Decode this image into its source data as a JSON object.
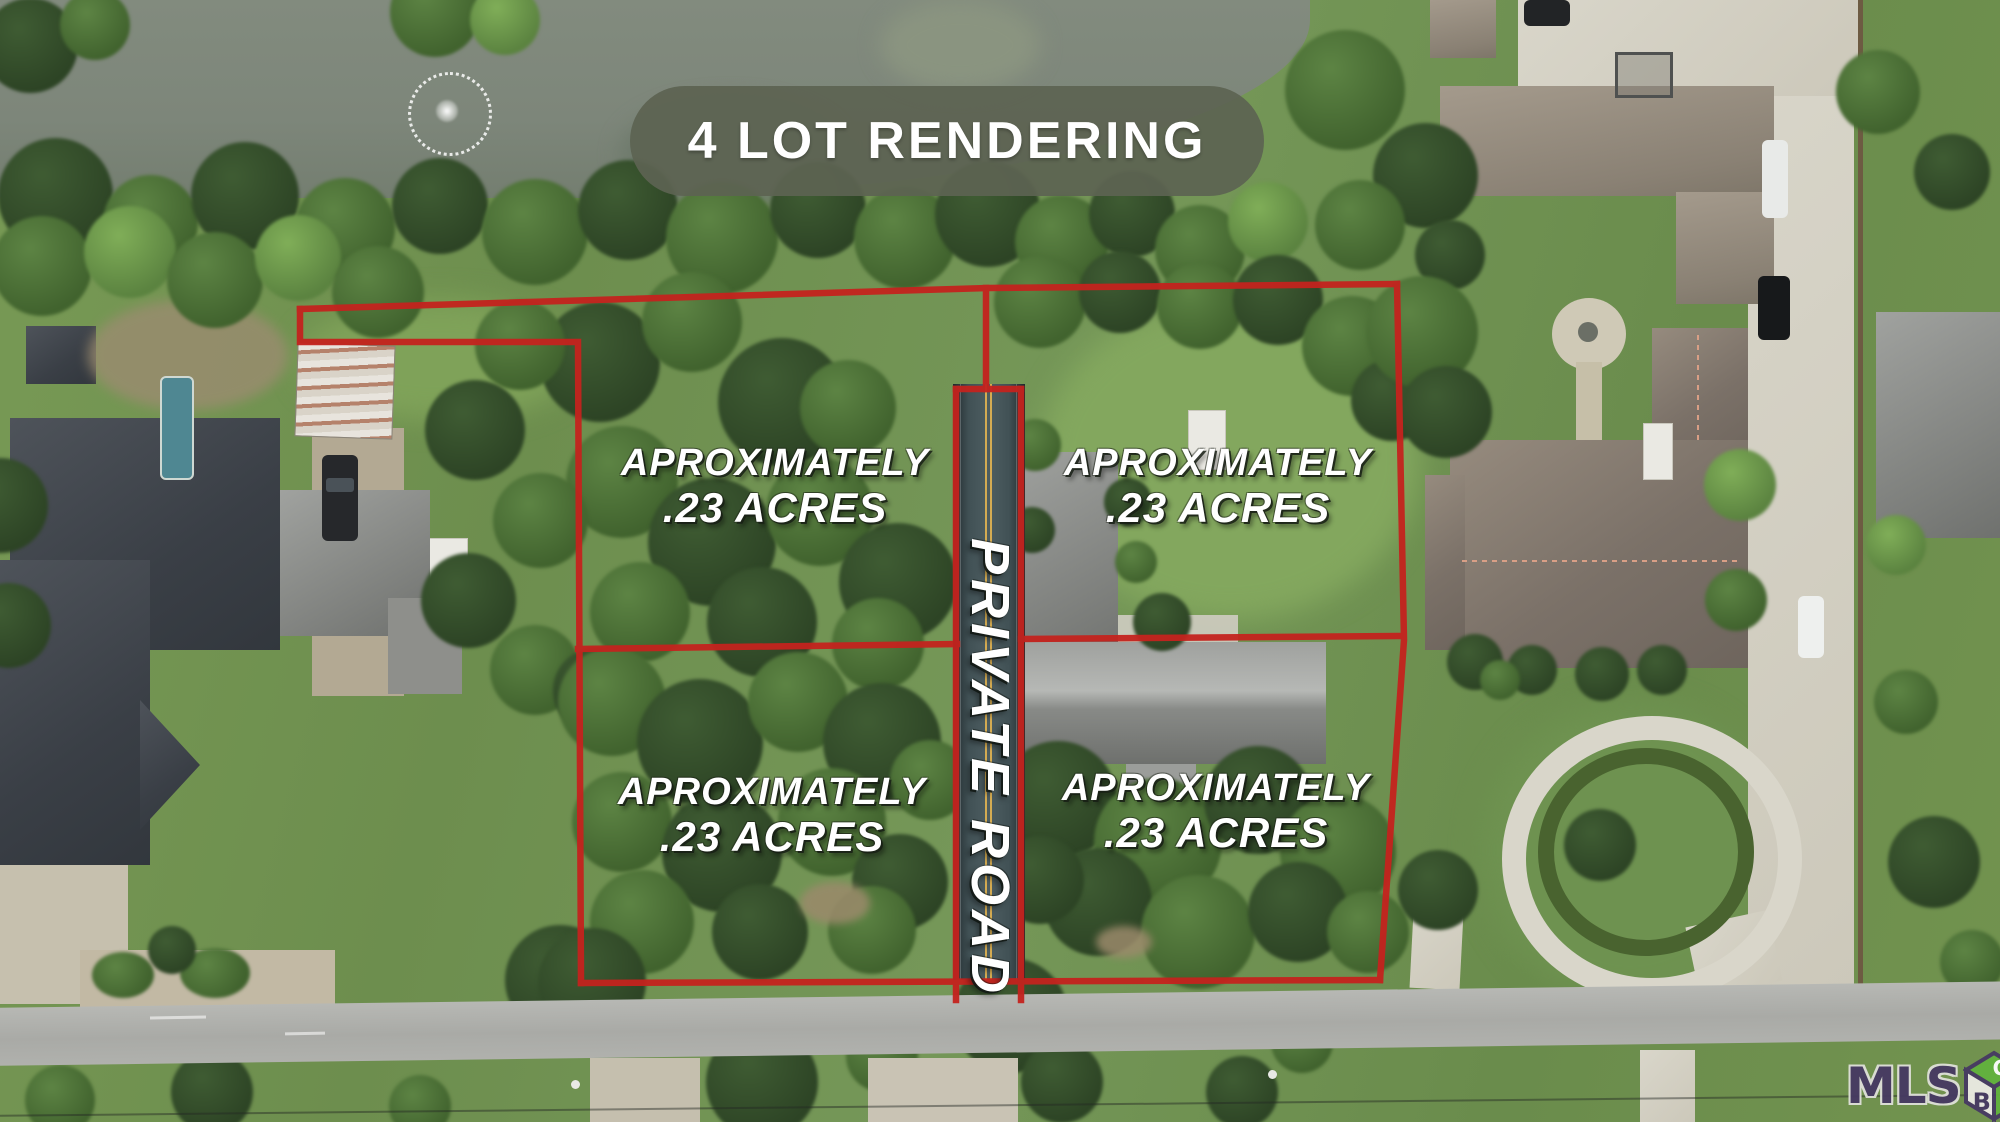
{
  "banner": {
    "title": "4 LOT RENDERING"
  },
  "lots": [
    {
      "line1": "APROXIMATELY",
      "line2": ".23 ACRES"
    },
    {
      "line1": "APROXIMATELY",
      "line2": ".23 ACRES"
    },
    {
      "line1": "APROXIMATELY",
      "line2": ".23 ACRES"
    },
    {
      "line1": "APROXIMATELY",
      "line2": ".23 ACRES"
    }
  ],
  "private_road": {
    "label": "PRIVATE ROAD"
  },
  "watermark": {
    "brand": "MLS",
    "cube": {
      "top_letter": "O",
      "left_letter": "B",
      "right_letter": "X"
    }
  },
  "colors": {
    "boundary_red": "#c4231e",
    "banner_bg": "#5c6352",
    "road_surface": "#3e4e51",
    "road_centerline": "#d4ab52",
    "water": "#7d867a",
    "label_text": "#ffffff",
    "logo_purple": "#463963",
    "logo_green": "#62b23e"
  }
}
